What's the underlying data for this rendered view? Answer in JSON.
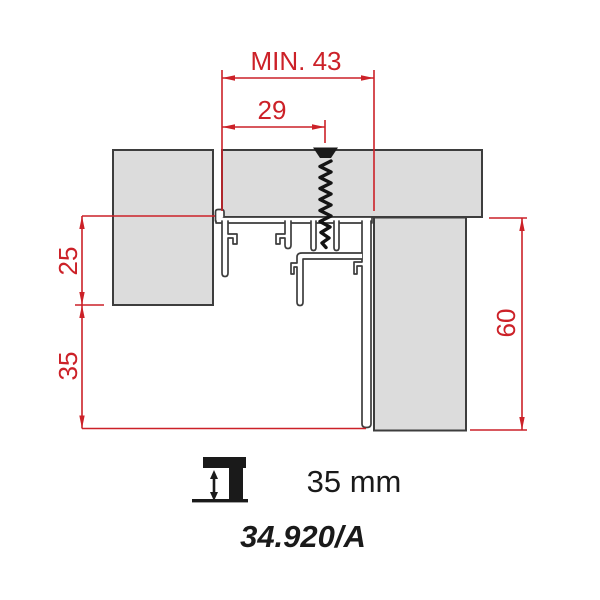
{
  "dimensions": {
    "min_width": "MIN. 43",
    "screw_offset": "29",
    "upper_height": "25",
    "lower_height": "35",
    "total_height": "60"
  },
  "footer": {
    "height_label": "35 mm",
    "part_number": "34.920/A",
    "icon": "height-adjust-double-arrow-icon"
  },
  "colors": {
    "dimension_red": "#cc2128",
    "panel_gray": "#dcdcdc",
    "outline": "#3d3d3d",
    "text_black": "#1a1a1a"
  }
}
